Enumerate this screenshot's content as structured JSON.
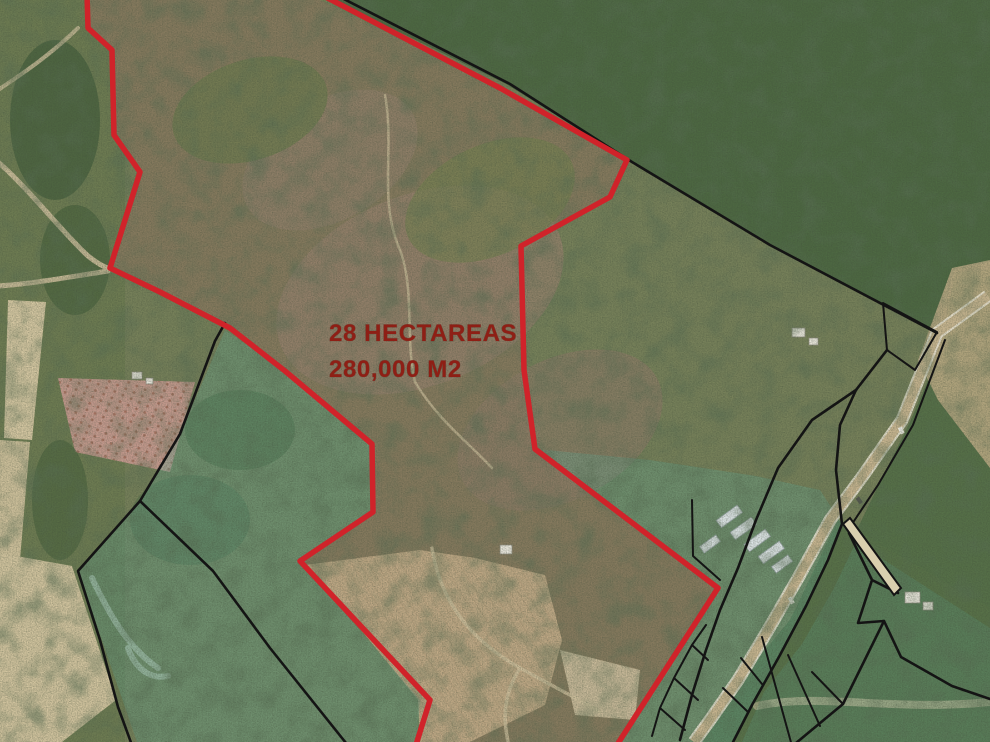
{
  "map": {
    "type": "satellite-parcel-map",
    "annotation": {
      "area_label_line1": "28 HECTAREAS",
      "area_label_line2": "280,000 M2"
    },
    "main_parcel": {
      "area_hectares": "28",
      "area_m2": "280,000",
      "boundary_style": "red outline"
    },
    "neighbor_parcels": {
      "boundary_style": "black outline",
      "highlight_style": "teal tint"
    },
    "colors": {
      "highlight_boundary": "#d0232a",
      "neighbor_boundary": "#141414",
      "label_text": "#8e1f15",
      "parcel_highlight_fill": "rgba(96,170,150,0.34)",
      "parcel_highlight_fill_light": "rgba(96,170,150,0.22)",
      "road_fill": "#c9b691",
      "forest_green": "#4d6842",
      "scrub_brown": "#867a5e",
      "orchard_pink": "#c79b8f",
      "field_tan": "#d3c49e"
    }
  }
}
